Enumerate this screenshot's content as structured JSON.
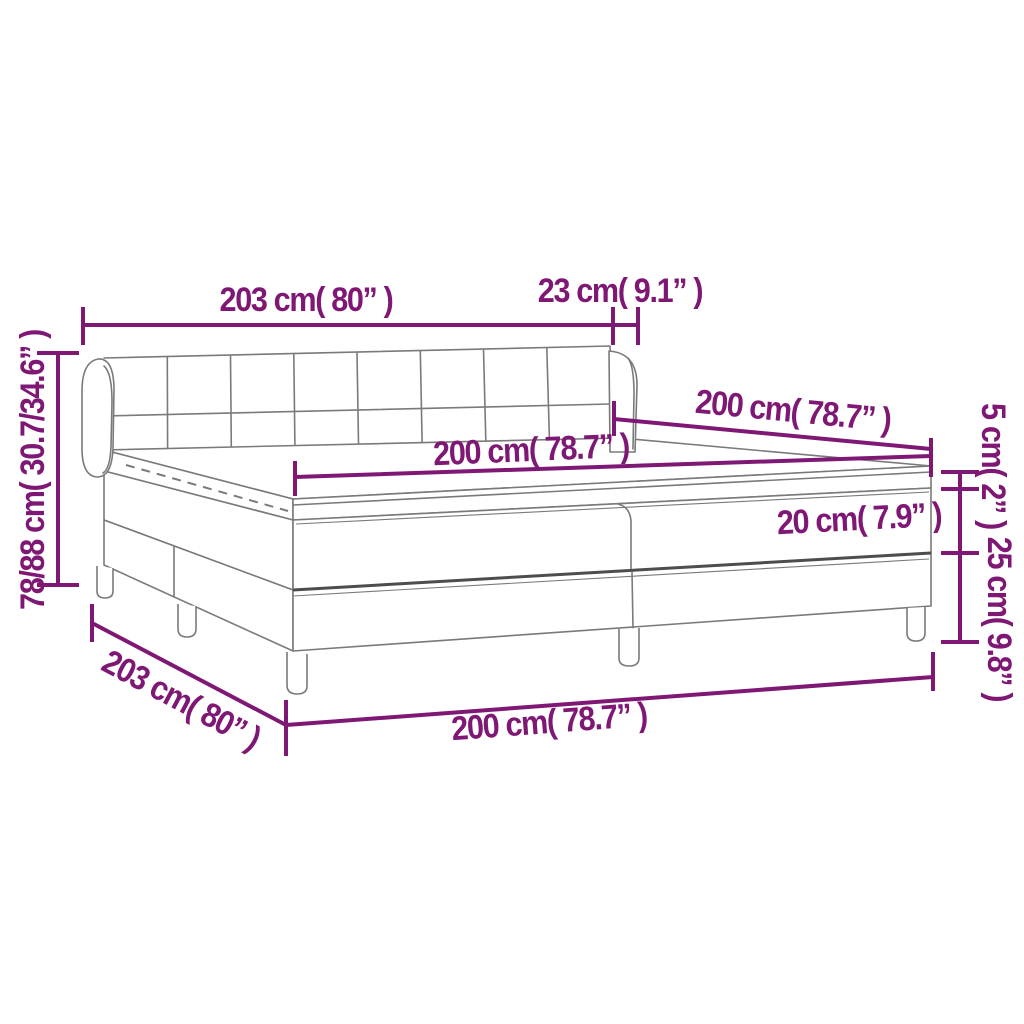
{
  "canvas": {
    "width": 1024,
    "height": 1024
  },
  "colors": {
    "dimension": "#7F1874",
    "outline": "#7A7A7A",
    "outline_dark": "#4D4D4D",
    "background": "#FFFFFF"
  },
  "drawing": {
    "subject": "box spring bed with tufted winged headboard, mattress topper, split base and legs"
  },
  "dimensions": {
    "headboard_width": {
      "label": "203 cm( 80” )"
    },
    "wing_depth": {
      "label": "23 cm( 9.1” )"
    },
    "total_height": {
      "label": "78/88 cm( 30.7/34.6” )"
    },
    "mattress_width": {
      "label": "200 cm( 78.7” )"
    },
    "bed_length": {
      "label": "200 cm( 78.7” )"
    },
    "topper_height": {
      "label": "5 cm( 2” )"
    },
    "mattress_height": {
      "label": "20 cm( 7.9” )"
    },
    "base_height": {
      "label": "25 cm( 9.8” )"
    },
    "base_length": {
      "label": "203 cm( 80” )"
    },
    "base_width": {
      "label": "200 cm( 78.7” )"
    }
  }
}
